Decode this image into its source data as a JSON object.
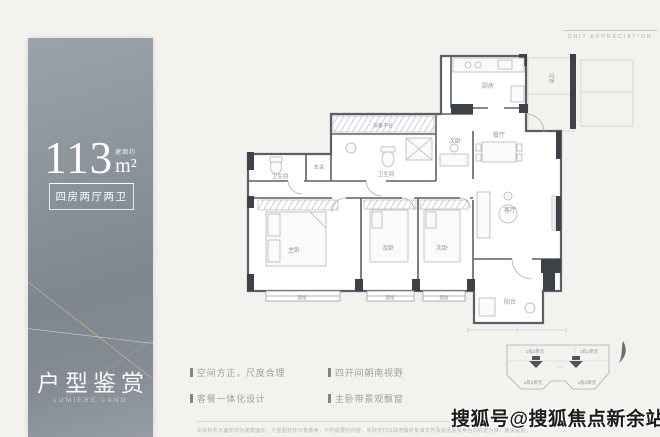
{
  "panel": {
    "area_prefix": "建面约",
    "area_number": "113",
    "area_unit": "m²",
    "layout_spec": "四房两厅两卫",
    "title": "户型鉴赏",
    "title_en": "LUMIERE LAND"
  },
  "header": {
    "caption": "UNIT APPRECIATION"
  },
  "floorplan": {
    "rooms": {
      "equipment": "设备平台",
      "bath_top": "卫生间",
      "bath_left": "卫生间",
      "foyer": "玄关",
      "kitchen": "厨房",
      "bedroom_top": "次卧",
      "dining": "餐厅",
      "living": "客厅",
      "balcony": "阳台",
      "master": "主卧",
      "bedroom2": "次卧",
      "bedroom3": "次卧",
      "corridor": "过道",
      "bay1": "飘窗",
      "bay2": "飘窗",
      "bay3": "飘窗"
    }
  },
  "features": {
    "items": [
      "空间方正，尺度合理",
      "客餐一体化设计",
      "四开间朝南视野",
      "主卧带景观飘窗"
    ]
  },
  "keyplan": {
    "units": {
      "u2": "1栋2单元",
      "u1": "1栋1单元",
      "u3": "1栋3单元",
      "u4": "1栋4单元"
    }
  },
  "footer": {
    "disclaimer": "本资料所示面积均为建筑面积，户型图仅作示意参考，不构成要约内容，实际交付以政府最终批准文件及商品房买卖合同约定为准，敬请留意。"
  },
  "watermark": "搜狐号@搜狐焦点新余站",
  "colors": {
    "accent_gold": "#cdb381",
    "wall_dark": "#3d4248",
    "label_gray": "#8d9298"
  }
}
